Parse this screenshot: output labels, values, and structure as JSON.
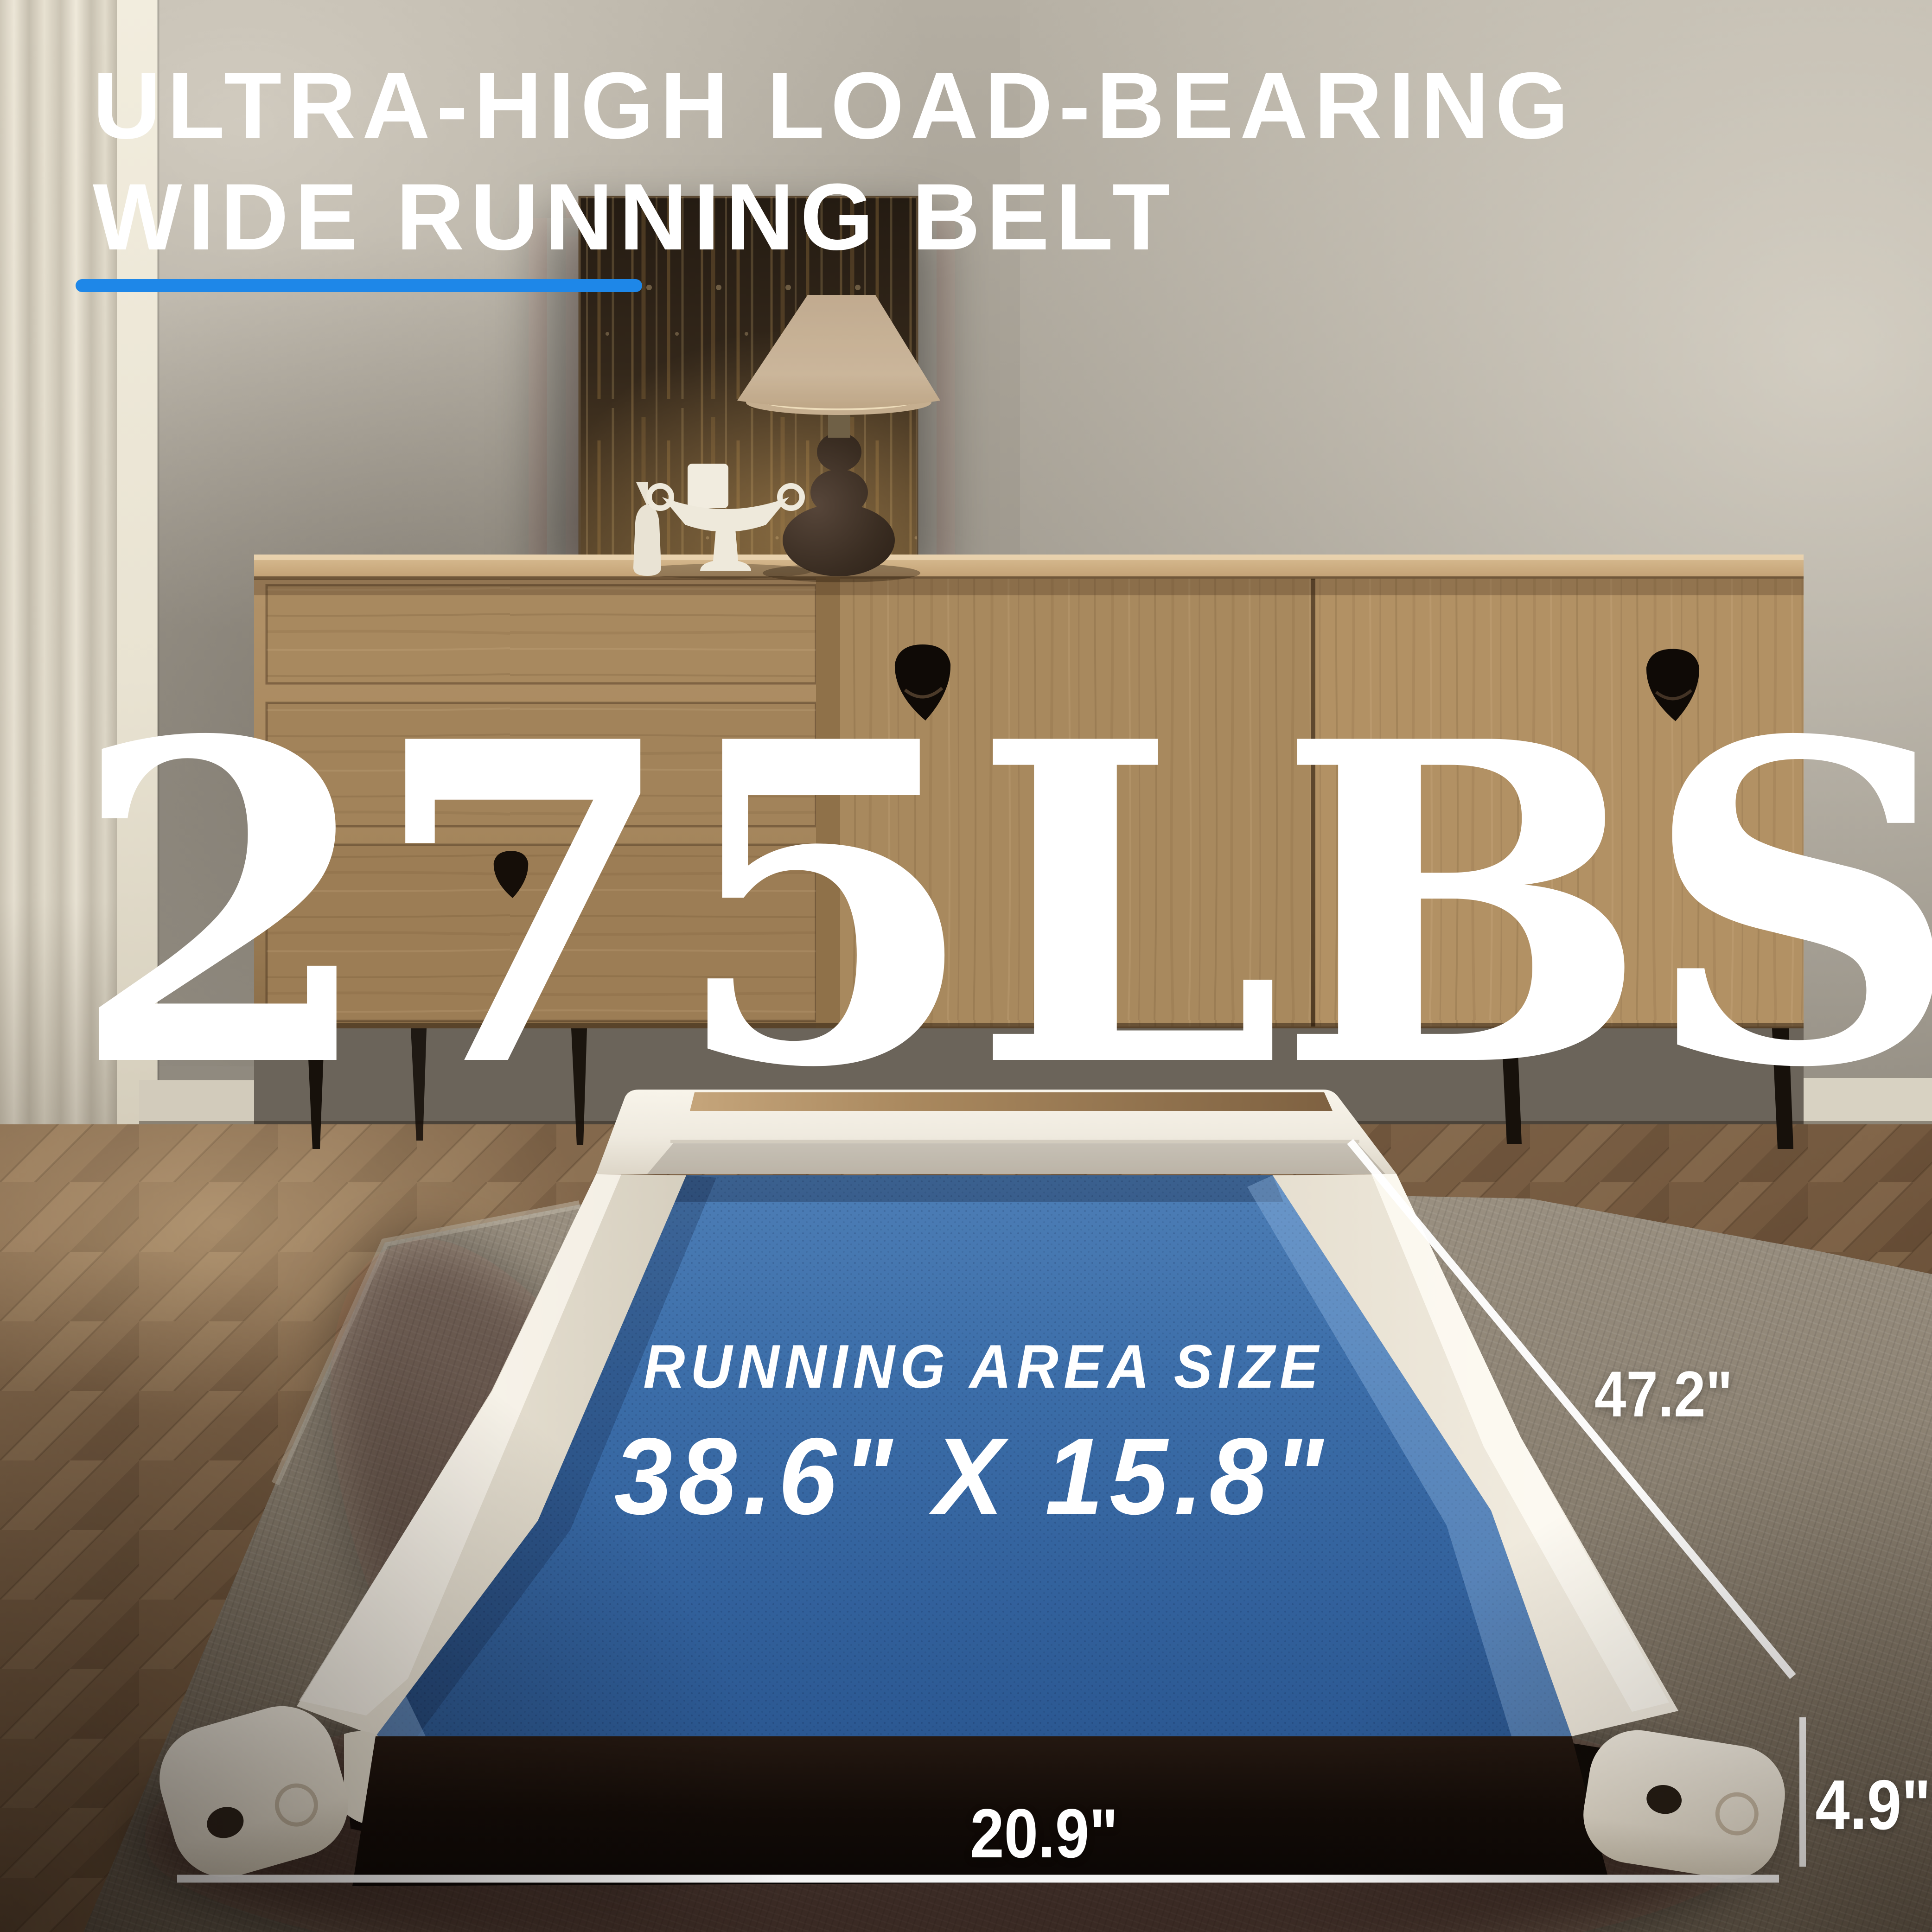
{
  "title": {
    "line1": "ULTRA-HIGH LOAD-BEARING",
    "line2": "WIDE RUNNING BELT"
  },
  "accent_color": "#1E87E8",
  "weight_capacity": "275LBS",
  "belt": {
    "heading": "RUNNING AREA SIZE",
    "area": "38.6\" X 15.8\"",
    "color": "#3A6CA8"
  },
  "dimensions": {
    "total_length": "47.2\"",
    "base_width": "20.9\"",
    "base_height": "4.9\""
  }
}
